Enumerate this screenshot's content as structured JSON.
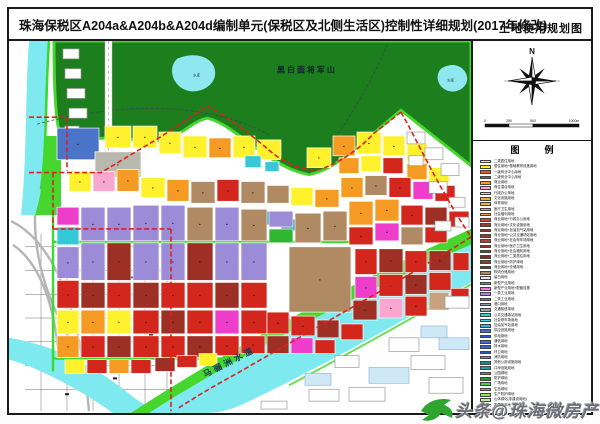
{
  "title_bar": {
    "title": "珠海保税区A204a&A204b&A204d编制单元(保税区及北侧生活区)控制性详细规划(2017年修改)",
    "map_type_label": "土地使用规划图"
  },
  "compass": {
    "north_label": "N"
  },
  "scale_bar": {
    "labels": [
      "0",
      "250",
      "500",
      "1000m"
    ]
  },
  "legend": {
    "header": "图　例",
    "items": [
      {
        "label": "二类居住用地",
        "color": "#FFF12B"
      },
      {
        "label": "居住用地+基础教育设施用地",
        "color": "#FFF12B"
      },
      {
        "label": "一级商业中心用地",
        "color": "#E8541E"
      },
      {
        "label": "二级商业中心用地",
        "color": "#BF4A28"
      },
      {
        "label": "商业用地",
        "color": "#F59A23"
      },
      {
        "label": "商住混合用地",
        "color": "#F8A8CF"
      },
      {
        "label": "行政办公用地",
        "color": "#F6B8D8"
      },
      {
        "label": "文化设施用地",
        "color": "#F2A93B"
      },
      {
        "label": "体育用地",
        "color": "#EFB03B"
      },
      {
        "label": "医疗卫生用地",
        "color": "#EF9A3F"
      },
      {
        "label": "社会福利用地",
        "color": "#F0A43C"
      },
      {
        "label": "商业用地+行政办公用地",
        "color": "#D84238"
      },
      {
        "label": "商业用地+文化设施用地",
        "color": "#A83626"
      },
      {
        "label": "商业用地+加油加气站用地",
        "color": "#8F3222"
      },
      {
        "label": "商业用地+公共交通场站用地",
        "color": "#9A3A2C"
      },
      {
        "label": "商业用地+社会停车场用地",
        "color": "#C43A2C"
      },
      {
        "label": "商业用地+医疗卫生用地",
        "color": "#93352A"
      },
      {
        "label": "商业用地+社会福利用地",
        "color": "#8C3226"
      },
      {
        "label": "商业用地+二类居住用地",
        "color": "#7E2E22"
      },
      {
        "label": "商业用地+防护绿地",
        "color": "#8A3A2E"
      },
      {
        "label": "商业用地+仓储用地",
        "color": "#7A3328"
      },
      {
        "label": "物流仓储用地",
        "color": "#B08A62"
      },
      {
        "label": "留白用地",
        "color": "#F2E6DC"
      },
      {
        "label": "新型产业用地",
        "color": "#EE3CCB"
      },
      {
        "label": "新型产业用地+配套设施",
        "color": "#F078D8"
      },
      {
        "label": "一类工业用地",
        "color": "#9C8BD6"
      },
      {
        "label": "二类工业用地",
        "color": "#7E6BC0"
      },
      {
        "label": "港口用地",
        "color": "#8C9AB0"
      },
      {
        "label": "交通枢纽用地",
        "color": "#9AA4B4"
      },
      {
        "label": "公共交通场站用地",
        "color": "#35C8D8"
      },
      {
        "label": "社会停车场用地",
        "color": "#49CFDD"
      },
      {
        "label": "加油加气站用地",
        "color": "#2FB6C8"
      },
      {
        "label": "供应设施用地",
        "color": "#3F6FD0"
      },
      {
        "label": "供电用地",
        "color": "#3558C0"
      },
      {
        "label": "通信用地",
        "color": "#4468CC"
      },
      {
        "label": "排水用地",
        "color": "#3A62C8"
      },
      {
        "label": "环卫用地",
        "color": "#2F55B8"
      },
      {
        "label": "消防用地",
        "color": "#2FA8C0"
      },
      {
        "label": "其他公用设施用地",
        "color": "#1F8C8C"
      },
      {
        "label": "口岸设施用地",
        "color": "#28A0A0"
      },
      {
        "label": "公园绿地",
        "color": "#2FB82F"
      },
      {
        "label": "防护绿地",
        "color": "#229922"
      },
      {
        "label": "广场用地",
        "color": "#55C855"
      },
      {
        "label": "生态绿地",
        "color": "#3ADB2F"
      },
      {
        "label": "生产防护绿地",
        "color": "#8FE05A"
      },
      {
        "label": "山体绿化(非建设用地)",
        "color": "#B8EBA0"
      },
      {
        "label": "发展备用地",
        "color": "#E8F2DC"
      },
      {
        "label": "湿地",
        "color": "#BFEFE8"
      },
      {
        "label": "水域",
        "color": "#72E3EE"
      },
      {
        "label": "城市道路用地",
        "color": "#FFFFFF"
      },
      {
        "label": "规划范围线",
        "color": "#FFFFFF",
        "dash": true
      }
    ]
  },
  "map": {
    "labels": {
      "mountain": "黑白面将军山",
      "waterway": "马骝洲水道",
      "reservoir_big": "水库",
      "reservoir_small": "水库"
    },
    "palette": {
      "Y": "#FFF12B",
      "O": "#F59A23",
      "R": "#D3261C",
      "RD": "#9E2F24",
      "BR": "#B08A62",
      "BR2": "#C9A17E",
      "PU": "#9C8BD6",
      "M": "#EE3CCB",
      "PK": "#F8A8CF",
      "C": "#35C8D8",
      "B": "#4A74C8",
      "GR": "#B9B9AF",
      "G": "#2FB82F",
      "TL": "#2E9E9E",
      "LB": "#CFE8F8",
      "WT": "#FFFFFF"
    },
    "parcels": [
      [
        54,
        8,
        16,
        10,
        "WT"
      ],
      [
        56,
        28,
        16,
        10,
        "WT"
      ],
      [
        58,
        48,
        18,
        10,
        "WT"
      ],
      [
        60,
        68,
        18,
        10,
        "WT"
      ],
      [
        56,
        86,
        14,
        8,
        "WT"
      ],
      [
        48,
        88,
        42,
        32,
        "B"
      ],
      [
        86,
        112,
        46,
        26,
        "GR"
      ],
      [
        96,
        86,
        26,
        22,
        "Y"
      ],
      [
        124,
        86,
        24,
        22,
        "Y"
      ],
      [
        150,
        92,
        22,
        22,
        "Y"
      ],
      [
        174,
        96,
        24,
        22,
        "Y"
      ],
      [
        200,
        98,
        22,
        20,
        "O"
      ],
      [
        224,
        96,
        22,
        22,
        "Y"
      ],
      [
        248,
        100,
        24,
        20,
        "Y"
      ],
      [
        298,
        108,
        24,
        20,
        "Y"
      ],
      [
        324,
        96,
        22,
        20,
        "O"
      ],
      [
        348,
        92,
        24,
        22,
        "Y"
      ],
      [
        374,
        96,
        22,
        20,
        "Y"
      ],
      [
        398,
        104,
        20,
        18,
        "Y"
      ],
      [
        330,
        118,
        20,
        16,
        "O"
      ],
      [
        352,
        116,
        20,
        16,
        "Y"
      ],
      [
        374,
        118,
        20,
        16,
        "R"
      ],
      [
        398,
        124,
        20,
        16,
        "O"
      ],
      [
        420,
        128,
        20,
        16,
        "Y"
      ],
      [
        250,
        172,
        18,
        14,
        "TL"
      ],
      [
        272,
        180,
        16,
        12,
        "TL"
      ],
      [
        236,
        116,
        16,
        12,
        "C"
      ],
      [
        256,
        122,
        14,
        10,
        "C"
      ],
      [
        60,
        132,
        22,
        20,
        "Y"
      ],
      [
        84,
        132,
        22,
        20,
        "PK"
      ],
      [
        108,
        130,
        22,
        22,
        "O"
      ],
      [
        132,
        138,
        24,
        20,
        "Y"
      ],
      [
        158,
        140,
        22,
        22,
        "O"
      ],
      [
        182,
        142,
        24,
        22,
        "BR"
      ],
      [
        208,
        140,
        22,
        22,
        "R"
      ],
      [
        232,
        142,
        24,
        22,
        "BR"
      ],
      [
        258,
        146,
        22,
        18,
        "BR"
      ],
      [
        282,
        148,
        22,
        18,
        "Y"
      ],
      [
        306,
        150,
        24,
        18,
        "O"
      ],
      [
        332,
        138,
        22,
        20,
        "O"
      ],
      [
        356,
        136,
        22,
        20,
        "BR"
      ],
      [
        380,
        138,
        22,
        20,
        "R"
      ],
      [
        404,
        142,
        20,
        18,
        "M"
      ],
      [
        426,
        146,
        20,
        16,
        "R"
      ],
      [
        48,
        168,
        22,
        18,
        "M"
      ],
      [
        48,
        188,
        22,
        18,
        "C"
      ],
      [
        72,
        168,
        24,
        34,
        "PU"
      ],
      [
        98,
        168,
        24,
        34,
        "PU"
      ],
      [
        124,
        166,
        26,
        36,
        "PU"
      ],
      [
        152,
        166,
        24,
        36,
        "PU"
      ],
      [
        178,
        168,
        26,
        34,
        "BR"
      ],
      [
        206,
        168,
        24,
        34,
        "PU"
      ],
      [
        232,
        170,
        26,
        32,
        "BR"
      ],
      [
        260,
        172,
        24,
        16,
        "PU"
      ],
      [
        260,
        190,
        24,
        14,
        "G"
      ],
      [
        286,
        174,
        26,
        30,
        "BR"
      ],
      [
        314,
        172,
        24,
        30,
        "BR"
      ],
      [
        340,
        162,
        24,
        24,
        "O"
      ],
      [
        366,
        160,
        24,
        22,
        "O"
      ],
      [
        392,
        166,
        22,
        20,
        "R"
      ],
      [
        416,
        168,
        22,
        18,
        "RD"
      ],
      [
        440,
        172,
        20,
        16,
        "R"
      ],
      [
        340,
        188,
        24,
        18,
        "R"
      ],
      [
        366,
        184,
        24,
        18,
        "M"
      ],
      [
        392,
        188,
        22,
        18,
        "BR"
      ],
      [
        416,
        188,
        22,
        16,
        "R"
      ],
      [
        48,
        208,
        22,
        32,
        "PU"
      ],
      [
        72,
        204,
        24,
        38,
        "PU"
      ],
      [
        98,
        204,
        24,
        38,
        "RD"
      ],
      [
        124,
        204,
        26,
        38,
        "PU"
      ],
      [
        152,
        204,
        24,
        38,
        "PU"
      ],
      [
        178,
        204,
        26,
        38,
        "RD"
      ],
      [
        206,
        204,
        24,
        38,
        "PU"
      ],
      [
        232,
        204,
        26,
        38,
        "PU"
      ],
      [
        280,
        208,
        62,
        66,
        "BR"
      ],
      [
        346,
        210,
        22,
        26,
        "R"
      ],
      [
        370,
        210,
        24,
        24,
        "RD"
      ],
      [
        396,
        212,
        22,
        22,
        "R"
      ],
      [
        420,
        212,
        22,
        20,
        "RD"
      ],
      [
        444,
        214,
        16,
        18,
        "R"
      ],
      [
        346,
        238,
        22,
        22,
        "M"
      ],
      [
        370,
        236,
        24,
        22,
        "R"
      ],
      [
        396,
        236,
        22,
        20,
        "RD"
      ],
      [
        420,
        234,
        22,
        18,
        "R"
      ],
      [
        48,
        242,
        22,
        28,
        "R"
      ],
      [
        72,
        244,
        24,
        26,
        "RD"
      ],
      [
        98,
        244,
        24,
        26,
        "R"
      ],
      [
        124,
        244,
        26,
        26,
        "RD"
      ],
      [
        152,
        244,
        24,
        26,
        "R"
      ],
      [
        178,
        244,
        26,
        26,
        "R"
      ],
      [
        206,
        244,
        24,
        26,
        "RD"
      ],
      [
        232,
        244,
        26,
        26,
        "R"
      ],
      [
        344,
        262,
        24,
        20,
        "RD"
      ],
      [
        370,
        260,
        24,
        20,
        "PK"
      ],
      [
        396,
        258,
        22,
        20,
        "R"
      ],
      [
        420,
        254,
        20,
        18,
        "BR2"
      ],
      [
        442,
        250,
        18,
        16,
        "R"
      ],
      [
        48,
        272,
        22,
        24,
        "Y"
      ],
      [
        72,
        272,
        24,
        24,
        "O"
      ],
      [
        98,
        272,
        24,
        24,
        "Y"
      ],
      [
        124,
        272,
        26,
        24,
        "R"
      ],
      [
        152,
        272,
        24,
        24,
        "RD"
      ],
      [
        178,
        272,
        26,
        24,
        "R"
      ],
      [
        206,
        272,
        24,
        24,
        "M"
      ],
      [
        232,
        272,
        26,
        24,
        "R"
      ],
      [
        258,
        274,
        22,
        22,
        "R"
      ],
      [
        282,
        278,
        24,
        20,
        "R"
      ],
      [
        308,
        282,
        22,
        18,
        "RD"
      ],
      [
        332,
        286,
        22,
        16,
        "R"
      ],
      [
        48,
        298,
        22,
        22,
        "O"
      ],
      [
        72,
        298,
        24,
        22,
        "R"
      ],
      [
        98,
        298,
        24,
        22,
        "RD"
      ],
      [
        124,
        298,
        26,
        22,
        "R"
      ],
      [
        152,
        298,
        24,
        22,
        "R"
      ],
      [
        178,
        298,
        26,
        22,
        "RD"
      ],
      [
        206,
        298,
        24,
        20,
        "R"
      ],
      [
        232,
        298,
        24,
        18,
        "R"
      ],
      [
        258,
        298,
        22,
        18,
        "RD"
      ],
      [
        282,
        300,
        22,
        16,
        "M"
      ],
      [
        306,
        302,
        20,
        14,
        "R"
      ],
      [
        56,
        322,
        20,
        14,
        "Y"
      ],
      [
        78,
        322,
        20,
        14,
        "R"
      ],
      [
        100,
        322,
        20,
        14,
        "O"
      ],
      [
        122,
        322,
        20,
        14,
        "R"
      ],
      [
        146,
        320,
        20,
        14,
        "RD"
      ],
      [
        168,
        318,
        20,
        12,
        "R"
      ],
      [
        190,
        316,
        18,
        12,
        "Y"
      ],
      [
        398,
        92,
        18,
        12,
        "WT"
      ],
      [
        416,
        108,
        18,
        12,
        "WT"
      ],
      [
        432,
        124,
        18,
        12,
        "WT"
      ],
      [
        400,
        116,
        14,
        10,
        "WT"
      ],
      [
        420,
        142,
        18,
        12,
        "WT"
      ],
      [
        440,
        158,
        16,
        10,
        "WT"
      ],
      [
        446,
        178,
        14,
        10,
        "WT"
      ],
      [
        426,
        182,
        16,
        10,
        "WT"
      ],
      [
        436,
        258,
        24,
        12,
        "WT"
      ],
      [
        380,
        300,
        30,
        14,
        "WT"
      ],
      [
        412,
        288,
        26,
        12,
        "LB"
      ],
      [
        360,
        330,
        40,
        16,
        "LB"
      ],
      [
        402,
        318,
        34,
        14,
        "WT"
      ],
      [
        430,
        300,
        30,
        12,
        "LB"
      ],
      [
        340,
        350,
        36,
        14,
        "WT"
      ],
      [
        300,
        352,
        30,
        12,
        "WT"
      ],
      [
        252,
        364,
        26,
        8,
        "WT"
      ],
      [
        420,
        340,
        34,
        16,
        "WT"
      ],
      [
        326,
        318,
        24,
        12,
        "WT"
      ],
      [
        296,
        336,
        26,
        12,
        "LB"
      ]
    ]
  },
  "watermark": {
    "text": "头条@珠海微房产"
  }
}
